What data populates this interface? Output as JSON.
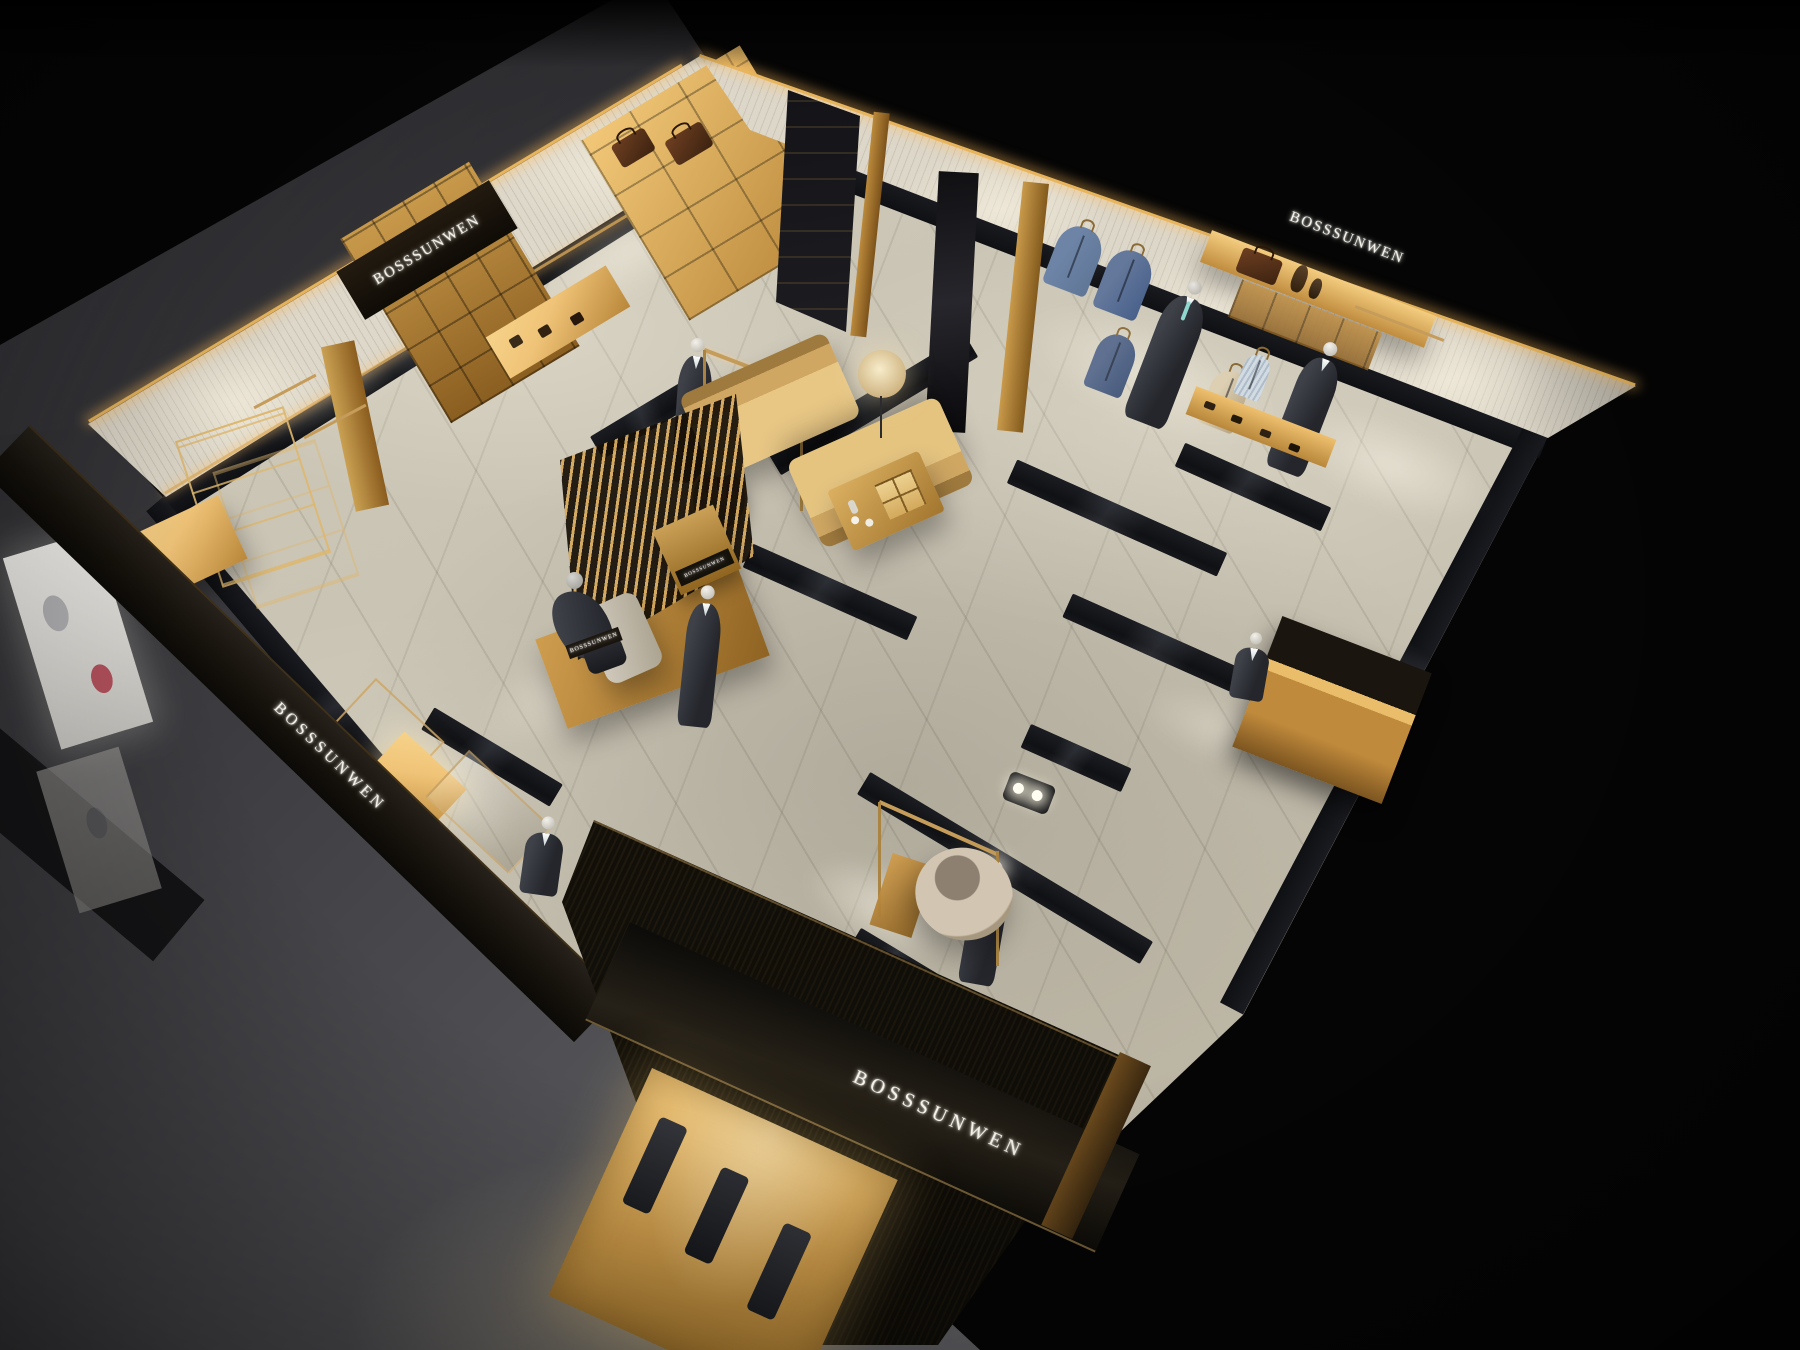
{
  "brand": "BOSSSUNWEN",
  "signs": {
    "wall_left": "BOSSSUNWEN",
    "wall_right": "BOSSSUNWEN",
    "fascia_left": "BOSSSUNWEN",
    "storefront": "BOSSSUNWEN",
    "display_plaque": "BOSSSUNWEN",
    "display_case": "BOSSSUNWEN"
  },
  "colors": {
    "bg": "#050505",
    "ground": "#55555a",
    "floor": "#c8c2b2",
    "marble": "#15161a",
    "wood": "#b98a3e",
    "wood_lit": "#f0c478",
    "brass": "#c59c5a",
    "panel": "#dcd6c8",
    "fascia": "#16120c",
    "suit": "#24262c",
    "blazer": "#5f7697",
    "mann": "#a9aaae",
    "sign": "#f5f2ea"
  }
}
